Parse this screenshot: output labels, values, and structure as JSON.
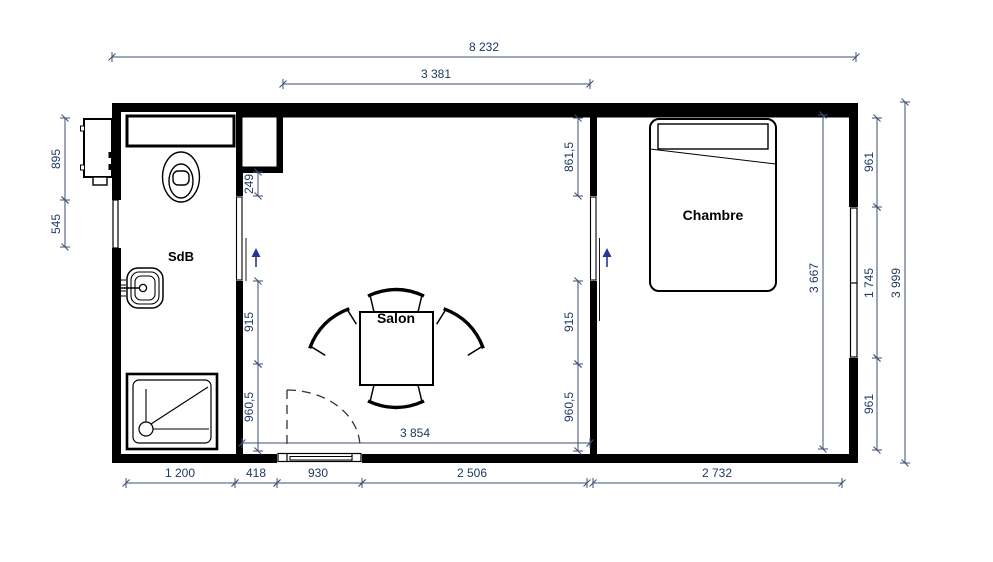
{
  "drawing": {
    "type": "floor-plan",
    "rooms": {
      "bathroom": "SdB",
      "living": "Salon",
      "bedroom": "Chambre"
    },
    "dimensions": {
      "top_total": "8 232",
      "top_salon": "3 381",
      "left_upper": "895",
      "left_window": "545",
      "closet_depth": "249",
      "salon_partition_upper": "861,5",
      "salon_left_mid": "915",
      "salon_left_lower": "960,5",
      "salon_right_mid": "915",
      "salon_right_lower": "960,5",
      "salon_width": "3 854",
      "bedroom_depth": "3 667",
      "right_wall_upper": "961",
      "right_window": "1 745",
      "right_wall_lower": "961",
      "right_total": "3 999",
      "bottom_bathroom": "1 200",
      "bottom_wall": "418",
      "bottom_door": "930",
      "bottom_salon": "2 506",
      "bottom_bedroom": "2 732"
    },
    "colors": {
      "walls": "#000000",
      "dimension_text": "#1F3864",
      "direction_arrows": "#283593",
      "background": "#FFFFFF"
    }
  }
}
